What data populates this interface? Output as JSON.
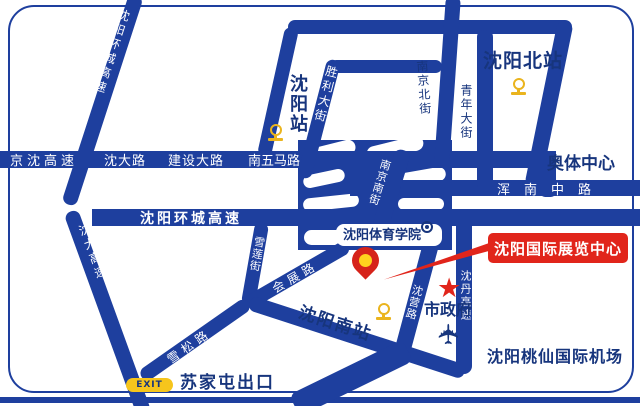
{
  "map": {
    "title_note": "Shenyang exhibition center access map",
    "stations": {
      "north": "沈阳北站",
      "central": "沈阳站",
      "south": "沈阳南站"
    },
    "landmarks": {
      "olympic": "奥体中心",
      "sport_institute": "沈阳体育学院",
      "city_hall": "市政府",
      "airport": "沈阳桃仙国际机场",
      "sujiatun_exit": "苏家屯出口",
      "exit_sign": "EXIT"
    },
    "highlight": {
      "exhibition_center": "沈阳国际展览中心"
    },
    "roads": {
      "jingshen_expwy": "京沈高速",
      "shenda_rd": "沈大路",
      "jianshe_rd": "建设大路",
      "nanwuma_rd": "南五马路",
      "ring_expwy_nw": "沈阳环城高速",
      "ring_expwy": "沈阳环城高速",
      "shenda_expwy": "沈大高速",
      "shengli_st": "胜利大街",
      "nanjing_north_st": "南京北街",
      "qingnian_st": "青年大街",
      "nanjing_south_st": "南京南街",
      "hunnan_rd": "浑南中路",
      "xuelian_st": "雪莲街",
      "huizhan_rd": "会展路",
      "xuesong_rd": "雪松路",
      "sutao_rd": "苏桃路",
      "shenying_rd": "沈营路",
      "shendan_expwy": "沈丹高速"
    },
    "icons": {
      "railway": "railway-station-icon",
      "college": "college-badge-icon",
      "airplane": "airplane-icon",
      "star": "city-hall-star-icon",
      "pin": "location-pin-icon"
    },
    "colors": {
      "road_blue": "#1e3f9e",
      "label_navy": "#17357d",
      "highlight_red": "#e1251b",
      "icon_gold": "#eab41e",
      "exit_yellow": "#f6c51c",
      "pin_inner_yellow": "#ffd21e"
    }
  }
}
